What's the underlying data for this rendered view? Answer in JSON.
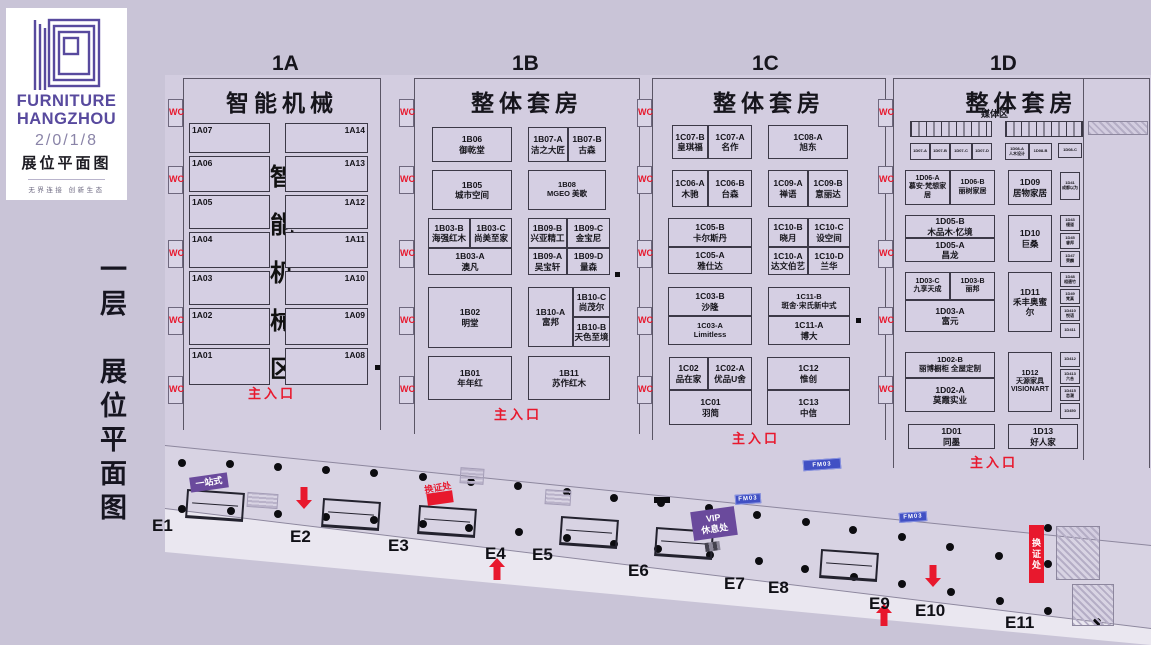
{
  "page": {
    "w": 1151,
    "h": 645,
    "bg": "#c9c4d7",
    "floor": "#d3cde0",
    "band": "#d8d3e3",
    "wedge": "#eae7f0",
    "line": "#8d879e",
    "red": "#e8182d",
    "purple": "#6a4a9c",
    "blue_pill": "#4150c4",
    "logo_purple": "#584a9e",
    "booth_fill": "#d5cfe3",
    "booth_border": "#3c3947"
  },
  "logo": {
    "line1": "FURNITURE",
    "line2": "HANGZHOU",
    "year": "2/0/1/8",
    "subtitle": "展位平面图",
    "tagline": "无界连接  创新生态"
  },
  "side_title": "一层　展位平面图",
  "wc": {
    "label": "WC",
    "ys": [
      107,
      174,
      248,
      315,
      384
    ]
  },
  "entrance_label": "主入口",
  "halls": [
    {
      "code": "1A",
      "name": "智能机械",
      "x": 183,
      "y": 78,
      "w": 198,
      "h": 352,
      "title_x": 272,
      "vertical_label": [
        "智",
        "能",
        "机",
        "械",
        "区"
      ],
      "entrance": {
        "x": 248,
        "y": 383
      }
    },
    {
      "code": "1B",
      "name": "整体套房",
      "x": 414,
      "y": 78,
      "w": 226,
      "h": 356,
      "title_x": 512,
      "entrance": {
        "x": 494,
        "y": 404
      }
    },
    {
      "code": "1C",
      "name": "整体套房",
      "x": 652,
      "y": 78,
      "w": 234,
      "h": 362,
      "title_x": 752,
      "entrance": {
        "x": 732,
        "y": 428
      }
    },
    {
      "code": "1D",
      "name": "整体套房",
      "x": 893,
      "y": 78,
      "w": 257,
      "h": 390,
      "title_x": 990,
      "sub_label": "媒体区",
      "inner_wall_x": 1083,
      "entrance": {
        "x": 970,
        "y": 452
      }
    }
  ],
  "booths": [
    {
      "id": "1A07",
      "name": "",
      "x": 189,
      "y": 123,
      "w": 81,
      "h": 30,
      "al": "l"
    },
    {
      "id": "1A14",
      "name": "",
      "x": 285,
      "y": 123,
      "w": 83,
      "h": 30,
      "al": "r"
    },
    {
      "id": "1A06",
      "name": "",
      "x": 189,
      "y": 156,
      "w": 81,
      "h": 36,
      "al": "l"
    },
    {
      "id": "1A13",
      "name": "",
      "x": 285,
      "y": 156,
      "w": 83,
      "h": 36,
      "al": "r"
    },
    {
      "id": "1A05",
      "name": "",
      "x": 189,
      "y": 195,
      "w": 81,
      "h": 34,
      "al": "l"
    },
    {
      "id": "1A12",
      "name": "",
      "x": 285,
      "y": 195,
      "w": 83,
      "h": 34,
      "al": "r"
    },
    {
      "id": "1A04",
      "name": "",
      "x": 189,
      "y": 232,
      "w": 81,
      "h": 36,
      "al": "l"
    },
    {
      "id": "1A11",
      "name": "",
      "x": 285,
      "y": 232,
      "w": 83,
      "h": 36,
      "al": "r"
    },
    {
      "id": "1A03",
      "name": "",
      "x": 189,
      "y": 271,
      "w": 81,
      "h": 34,
      "al": "l"
    },
    {
      "id": "1A10",
      "name": "",
      "x": 285,
      "y": 271,
      "w": 83,
      "h": 34,
      "al": "r"
    },
    {
      "id": "1A02",
      "name": "",
      "x": 189,
      "y": 308,
      "w": 81,
      "h": 37,
      "al": "l"
    },
    {
      "id": "1A09",
      "name": "",
      "x": 285,
      "y": 308,
      "w": 83,
      "h": 37,
      "al": "r"
    },
    {
      "id": "1A01",
      "name": "",
      "x": 189,
      "y": 348,
      "w": 81,
      "h": 37,
      "al": "l"
    },
    {
      "id": "1A08",
      "name": "",
      "x": 285,
      "y": 348,
      "w": 83,
      "h": 37,
      "al": "r"
    },
    {
      "id": "1B06",
      "name": "御乾堂",
      "x": 432,
      "y": 127,
      "w": 80,
      "h": 35
    },
    {
      "id": "1B07-A",
      "name": "洁之大匠",
      "x": 528,
      "y": 127,
      "w": 40,
      "h": 35
    },
    {
      "id": "1B07-B",
      "name": "古森",
      "x": 568,
      "y": 127,
      "w": 38,
      "h": 35
    },
    {
      "id": "1B05",
      "name": "城市空间",
      "x": 432,
      "y": 170,
      "w": 80,
      "h": 40
    },
    {
      "id": "1B08",
      "name": "MGEO 美歌",
      "x": 528,
      "y": 170,
      "w": 78,
      "h": 40
    },
    {
      "id": "1B03-B",
      "name": "海强红木",
      "x": 428,
      "y": 218,
      "w": 42,
      "h": 30
    },
    {
      "id": "1B03-C",
      "name": "尚美至家",
      "x": 470,
      "y": 218,
      "w": 42,
      "h": 30
    },
    {
      "id": "1B03-A",
      "name": "澳凡",
      "x": 428,
      "y": 248,
      "w": 84,
      "h": 27
    },
    {
      "id": "1B09-B",
      "name": "兴亚精工",
      "x": 528,
      "y": 218,
      "w": 39,
      "h": 30
    },
    {
      "id": "1B09-C",
      "name": "金宝尼",
      "x": 567,
      "y": 218,
      "w": 43,
      "h": 30
    },
    {
      "id": "1B09-A",
      "name": "吴宝轩",
      "x": 528,
      "y": 248,
      "w": 39,
      "h": 27
    },
    {
      "id": "1B09-D",
      "name": "量森",
      "x": 567,
      "y": 248,
      "w": 43,
      "h": 27
    },
    {
      "id": "1B02",
      "name": "明堂",
      "x": 428,
      "y": 287,
      "w": 84,
      "h": 61
    },
    {
      "id": "1B10-A",
      "name": "富邦",
      "x": 528,
      "y": 287,
      "w": 45,
      "h": 60
    },
    {
      "id": "1B10-C",
      "name": "尚茂尔",
      "x": 573,
      "y": 287,
      "w": 37,
      "h": 30
    },
    {
      "id": "1B10-B",
      "name": "天色至境",
      "x": 573,
      "y": 317,
      "w": 37,
      "h": 30
    },
    {
      "id": "1B01",
      "name": "年年红",
      "x": 428,
      "y": 356,
      "w": 84,
      "h": 44
    },
    {
      "id": "1B11",
      "name": "苏作红木",
      "x": 528,
      "y": 356,
      "w": 82,
      "h": 44
    },
    {
      "id": "1C07-B",
      "name": "皇琪福",
      "x": 672,
      "y": 125,
      "w": 36,
      "h": 34
    },
    {
      "id": "1C07-A",
      "name": "名作",
      "x": 708,
      "y": 125,
      "w": 44,
      "h": 34
    },
    {
      "id": "1C08-A",
      "name": "旭东",
      "x": 768,
      "y": 125,
      "w": 80,
      "h": 34
    },
    {
      "id": "1C06-A",
      "name": "木驰",
      "x": 672,
      "y": 170,
      "w": 36,
      "h": 37
    },
    {
      "id": "1C06-B",
      "name": "台森",
      "x": 708,
      "y": 170,
      "w": 44,
      "h": 37
    },
    {
      "id": "1C09-A",
      "name": "禅语",
      "x": 768,
      "y": 170,
      "w": 40,
      "h": 37
    },
    {
      "id": "1C09-B",
      "name": "意丽达",
      "x": 808,
      "y": 170,
      "w": 40,
      "h": 37
    },
    {
      "id": "1C05-B",
      "name": "卡尔斯丹",
      "x": 668,
      "y": 218,
      "w": 84,
      "h": 29
    },
    {
      "id": "1C05-A",
      "name": "雅仕达",
      "x": 668,
      "y": 247,
      "w": 84,
      "h": 27
    },
    {
      "id": "1C10-B",
      "name": "晓月",
      "x": 768,
      "y": 218,
      "w": 40,
      "h": 29
    },
    {
      "id": "1C10-C",
      "name": "设空间",
      "x": 808,
      "y": 218,
      "w": 42,
      "h": 29
    },
    {
      "id": "1C10-A",
      "name": "达文伯艺",
      "x": 768,
      "y": 247,
      "w": 40,
      "h": 28
    },
    {
      "id": "1C10-D",
      "name": "兰华",
      "x": 808,
      "y": 247,
      "w": 42,
      "h": 28
    },
    {
      "id": "1C03-B",
      "name": "沙隆",
      "x": 668,
      "y": 287,
      "w": 84,
      "h": 29
    },
    {
      "id": "1C03-A",
      "name": "Limitless",
      "x": 668,
      "y": 316,
      "w": 84,
      "h": 29
    },
    {
      "id": "1C11-B",
      "name": "斑舍·宋氏新中式",
      "x": 768,
      "y": 287,
      "w": 82,
      "h": 29
    },
    {
      "id": "1C11-A",
      "name": "博大",
      "x": 768,
      "y": 316,
      "w": 82,
      "h": 29
    },
    {
      "id": "1C02",
      "name": "品在家",
      "x": 669,
      "y": 357,
      "w": 39,
      "h": 33
    },
    {
      "id": "1C02-A",
      "name": "优品U舍",
      "x": 708,
      "y": 357,
      "w": 44,
      "h": 33
    },
    {
      "id": "1C01",
      "name": "羽简",
      "x": 669,
      "y": 390,
      "w": 83,
      "h": 35
    },
    {
      "id": "1C12",
      "name": "惟创",
      "x": 767,
      "y": 357,
      "w": 83,
      "h": 33
    },
    {
      "id": "1C13",
      "name": "中信",
      "x": 767,
      "y": 390,
      "w": 83,
      "h": 35
    },
    {
      "id": "1D07-A",
      "name": "",
      "x": 910,
      "y": 143,
      "w": 20,
      "h": 17,
      "fs": 4
    },
    {
      "id": "1D07-B",
      "name": "",
      "x": 930,
      "y": 143,
      "w": 20,
      "h": 17,
      "fs": 4
    },
    {
      "id": "1D07-C",
      "name": "",
      "x": 950,
      "y": 143,
      "w": 22,
      "h": 17,
      "fs": 4
    },
    {
      "id": "1D07-D",
      "name": "",
      "x": 972,
      "y": 143,
      "w": 20,
      "h": 17,
      "fs": 4
    },
    {
      "id": "1D08-A",
      "name": "人木设计",
      "x": 1005,
      "y": 143,
      "w": 24,
      "h": 17,
      "fs": 4
    },
    {
      "id": "1D08-B",
      "name": "",
      "x": 1029,
      "y": 143,
      "w": 23,
      "h": 17,
      "fs": 4
    },
    {
      "id": "1D08-C",
      "name": "",
      "x": 1058,
      "y": 143,
      "w": 24,
      "h": 15,
      "fs": 4
    },
    {
      "id": "1D06-A",
      "name": "慕安·梵想家居",
      "x": 905,
      "y": 170,
      "w": 45,
      "h": 35,
      "fs": 7
    },
    {
      "id": "1D06-B",
      "name": "丽树家居",
      "x": 950,
      "y": 170,
      "w": 45,
      "h": 35,
      "fs": 7
    },
    {
      "id": "1D09",
      "name": "居物家居",
      "x": 1008,
      "y": 170,
      "w": 44,
      "h": 35
    },
    {
      "id": "1D41",
      "name": "成都以为",
      "x": 1060,
      "y": 172,
      "w": 20,
      "h": 28,
      "fs": 4
    },
    {
      "id": "1D05-B",
      "name": "木品木·忆境",
      "x": 905,
      "y": 215,
      "w": 90,
      "h": 23
    },
    {
      "id": "1D05-A",
      "name": "昌龙",
      "x": 905,
      "y": 238,
      "w": 90,
      "h": 24
    },
    {
      "id": "1D10",
      "name": "巨桑",
      "x": 1008,
      "y": 215,
      "w": 44,
      "h": 47
    },
    {
      "id": "1D43",
      "name": "缦道",
      "x": 1060,
      "y": 215,
      "w": 20,
      "h": 16,
      "fs": 4
    },
    {
      "id": "1D45",
      "name": "睿邦",
      "x": 1060,
      "y": 233,
      "w": 20,
      "h": 16,
      "fs": 4
    },
    {
      "id": "1D47",
      "name": "荣麟",
      "x": 1060,
      "y": 251,
      "w": 20,
      "h": 16,
      "fs": 4
    },
    {
      "id": "1D03-C",
      "name": "九享天成",
      "x": 905,
      "y": 272,
      "w": 45,
      "h": 28,
      "fs": 7
    },
    {
      "id": "1D03-B",
      "name": "丽邦",
      "x": 950,
      "y": 272,
      "w": 45,
      "h": 28,
      "fs": 7
    },
    {
      "id": "1D03-A",
      "name": "富元",
      "x": 905,
      "y": 300,
      "w": 90,
      "h": 32
    },
    {
      "id": "1D11",
      "name": "禾丰奥蜜尔",
      "x": 1008,
      "y": 272,
      "w": 44,
      "h": 60
    },
    {
      "id": "1D48",
      "name": "相遇竹",
      "x": 1060,
      "y": 272,
      "w": 20,
      "h": 15,
      "fs": 4
    },
    {
      "id": "1D49",
      "name": "梵真",
      "x": 1060,
      "y": 289,
      "w": 20,
      "h": 15,
      "fs": 4
    },
    {
      "id": "1D410",
      "name": "悦语",
      "x": 1060,
      "y": 306,
      "w": 20,
      "h": 15,
      "fs": 4
    },
    {
      "id": "1D411",
      "name": "",
      "x": 1060,
      "y": 323,
      "w": 20,
      "h": 15,
      "fs": 4
    },
    {
      "id": "1D02-B",
      "name": "丽博橱柜 全屋定制",
      "x": 905,
      "y": 352,
      "w": 90,
      "h": 26
    },
    {
      "id": "1D02-A",
      "name": "莫霞实业",
      "x": 905,
      "y": 378,
      "w": 90,
      "h": 34
    },
    {
      "id": "1D12",
      "name": "天源家具 VISIONART",
      "x": 1008,
      "y": 352,
      "w": 44,
      "h": 60,
      "fs": 7
    },
    {
      "id": "1D412",
      "name": "",
      "x": 1060,
      "y": 352,
      "w": 20,
      "h": 15,
      "fs": 4
    },
    {
      "id": "1D413",
      "name": "六合",
      "x": 1060,
      "y": 369,
      "w": 20,
      "h": 15,
      "fs": 4
    },
    {
      "id": "1D415",
      "name": "恋潮",
      "x": 1060,
      "y": 386,
      "w": 20,
      "h": 15,
      "fs": 4
    },
    {
      "id": "1D450",
      "name": "",
      "x": 1060,
      "y": 403,
      "w": 20,
      "h": 16,
      "fs": 4
    },
    {
      "id": "1D01",
      "name": "同墨",
      "x": 908,
      "y": 424,
      "w": 87,
      "h": 25
    },
    {
      "id": "1D13",
      "name": "好人家",
      "x": 1008,
      "y": 424,
      "w": 70,
      "h": 25
    }
  ],
  "media_strips": [
    {
      "x": 910,
      "y": 121,
      "w": 82,
      "h": 16,
      "cell": 7.5
    },
    {
      "x": 1005,
      "y": 121,
      "w": 78,
      "h": 16,
      "cell": 7.5
    }
  ],
  "gates": [
    {
      "label": "E1",
      "x": 152,
      "y": 516
    },
    {
      "label": "E2",
      "x": 290,
      "y": 527
    },
    {
      "label": "E3",
      "x": 388,
      "y": 536
    },
    {
      "label": "E4",
      "x": 485,
      "y": 544
    },
    {
      "label": "E5",
      "x": 532,
      "y": 545
    },
    {
      "label": "E6",
      "x": 628,
      "y": 561
    },
    {
      "label": "E7",
      "x": 724,
      "y": 574
    },
    {
      "label": "E8",
      "x": 768,
      "y": 578
    },
    {
      "label": "E9",
      "x": 869,
      "y": 594
    },
    {
      "label": "E10",
      "x": 915,
      "y": 601
    },
    {
      "label": "E11",
      "x": 1005,
      "y": 613
    }
  ],
  "dots": [
    [
      182,
      463
    ],
    [
      230,
      464
    ],
    [
      278,
      467
    ],
    [
      326,
      470
    ],
    [
      374,
      473
    ],
    [
      423,
      477
    ],
    [
      471,
      482
    ],
    [
      518,
      486
    ],
    [
      567,
      492
    ],
    [
      614,
      498
    ],
    [
      661,
      503
    ],
    [
      709,
      508
    ],
    [
      757,
      515
    ],
    [
      806,
      522
    ],
    [
      853,
      530
    ],
    [
      902,
      537
    ],
    [
      950,
      547
    ],
    [
      999,
      556
    ],
    [
      1048,
      528
    ],
    [
      182,
      509
    ],
    [
      231,
      511
    ],
    [
      278,
      514
    ],
    [
      326,
      517
    ],
    [
      374,
      520
    ],
    [
      423,
      524
    ],
    [
      469,
      528
    ],
    [
      519,
      532
    ],
    [
      567,
      538
    ],
    [
      614,
      544
    ],
    [
      658,
      549
    ],
    [
      710,
      555
    ],
    [
      759,
      561
    ],
    [
      805,
      569
    ],
    [
      854,
      577
    ],
    [
      902,
      584
    ],
    [
      951,
      592
    ],
    [
      1000,
      601
    ],
    [
      1048,
      611
    ],
    [
      1097,
      622
    ],
    [
      1048,
      564
    ]
  ],
  "arrows": {
    "down": [
      [
        296,
        487
      ],
      [
        925,
        565
      ]
    ],
    "up": [
      [
        489,
        558
      ],
      [
        876,
        604
      ]
    ]
  },
  "badges": [
    {
      "type": "purple",
      "text": "一站式",
      "x": 190,
      "y": 475,
      "w": 38,
      "h": 15,
      "rot": -8,
      "fs": 9
    },
    {
      "type": "redtext",
      "text": "换证处",
      "x": 424,
      "y": 480,
      "w": 36,
      "h": 11,
      "rot": -10,
      "fs": 9
    },
    {
      "type": "redfill",
      "text": "",
      "x": 427,
      "y": 492,
      "w": 26,
      "h": 12,
      "rot": -8,
      "fs": 0
    },
    {
      "type": "purple",
      "text": "VIP 休息处",
      "x": 692,
      "y": 509,
      "w": 44,
      "h": 29,
      "rot": -8,
      "fs": 9
    },
    {
      "type": "checker",
      "text": "",
      "x": 705,
      "y": 542,
      "w": 15,
      "h": 9,
      "rot": -8,
      "fs": 0
    },
    {
      "type": "redvert",
      "text": "换证处",
      "x": 1029,
      "y": 525,
      "w": 15,
      "h": 58,
      "rot": 0,
      "fs": 9
    }
  ],
  "pills": [
    {
      "text": "FM03",
      "x": 803,
      "y": 459,
      "w": 36,
      "h": 9
    },
    {
      "text": "FM03",
      "x": 735,
      "y": 494,
      "w": 24,
      "h": 8
    },
    {
      "text": "FM03",
      "x": 899,
      "y": 512,
      "w": 26,
      "h": 8
    }
  ],
  "turnstiles": [
    [
      186,
      491
    ],
    [
      322,
      500
    ],
    [
      418,
      507
    ],
    [
      560,
      518
    ],
    [
      655,
      529
    ],
    [
      820,
      551
    ]
  ],
  "stripe_boxes": [
    [
      247,
      493,
      29,
      13
    ],
    [
      545,
      490,
      24,
      13
    ],
    [
      460,
      468,
      22,
      14
    ]
  ],
  "black_bar": [
    654,
    497,
    16,
    6
  ],
  "wall_marks": [
    [
      375,
      365
    ],
    [
      615,
      272
    ],
    [
      856,
      318
    ]
  ],
  "hatches": [
    [
      1056,
      526,
      42,
      52
    ],
    [
      1072,
      584,
      40,
      40
    ],
    [
      1088,
      121,
      58,
      12
    ]
  ]
}
